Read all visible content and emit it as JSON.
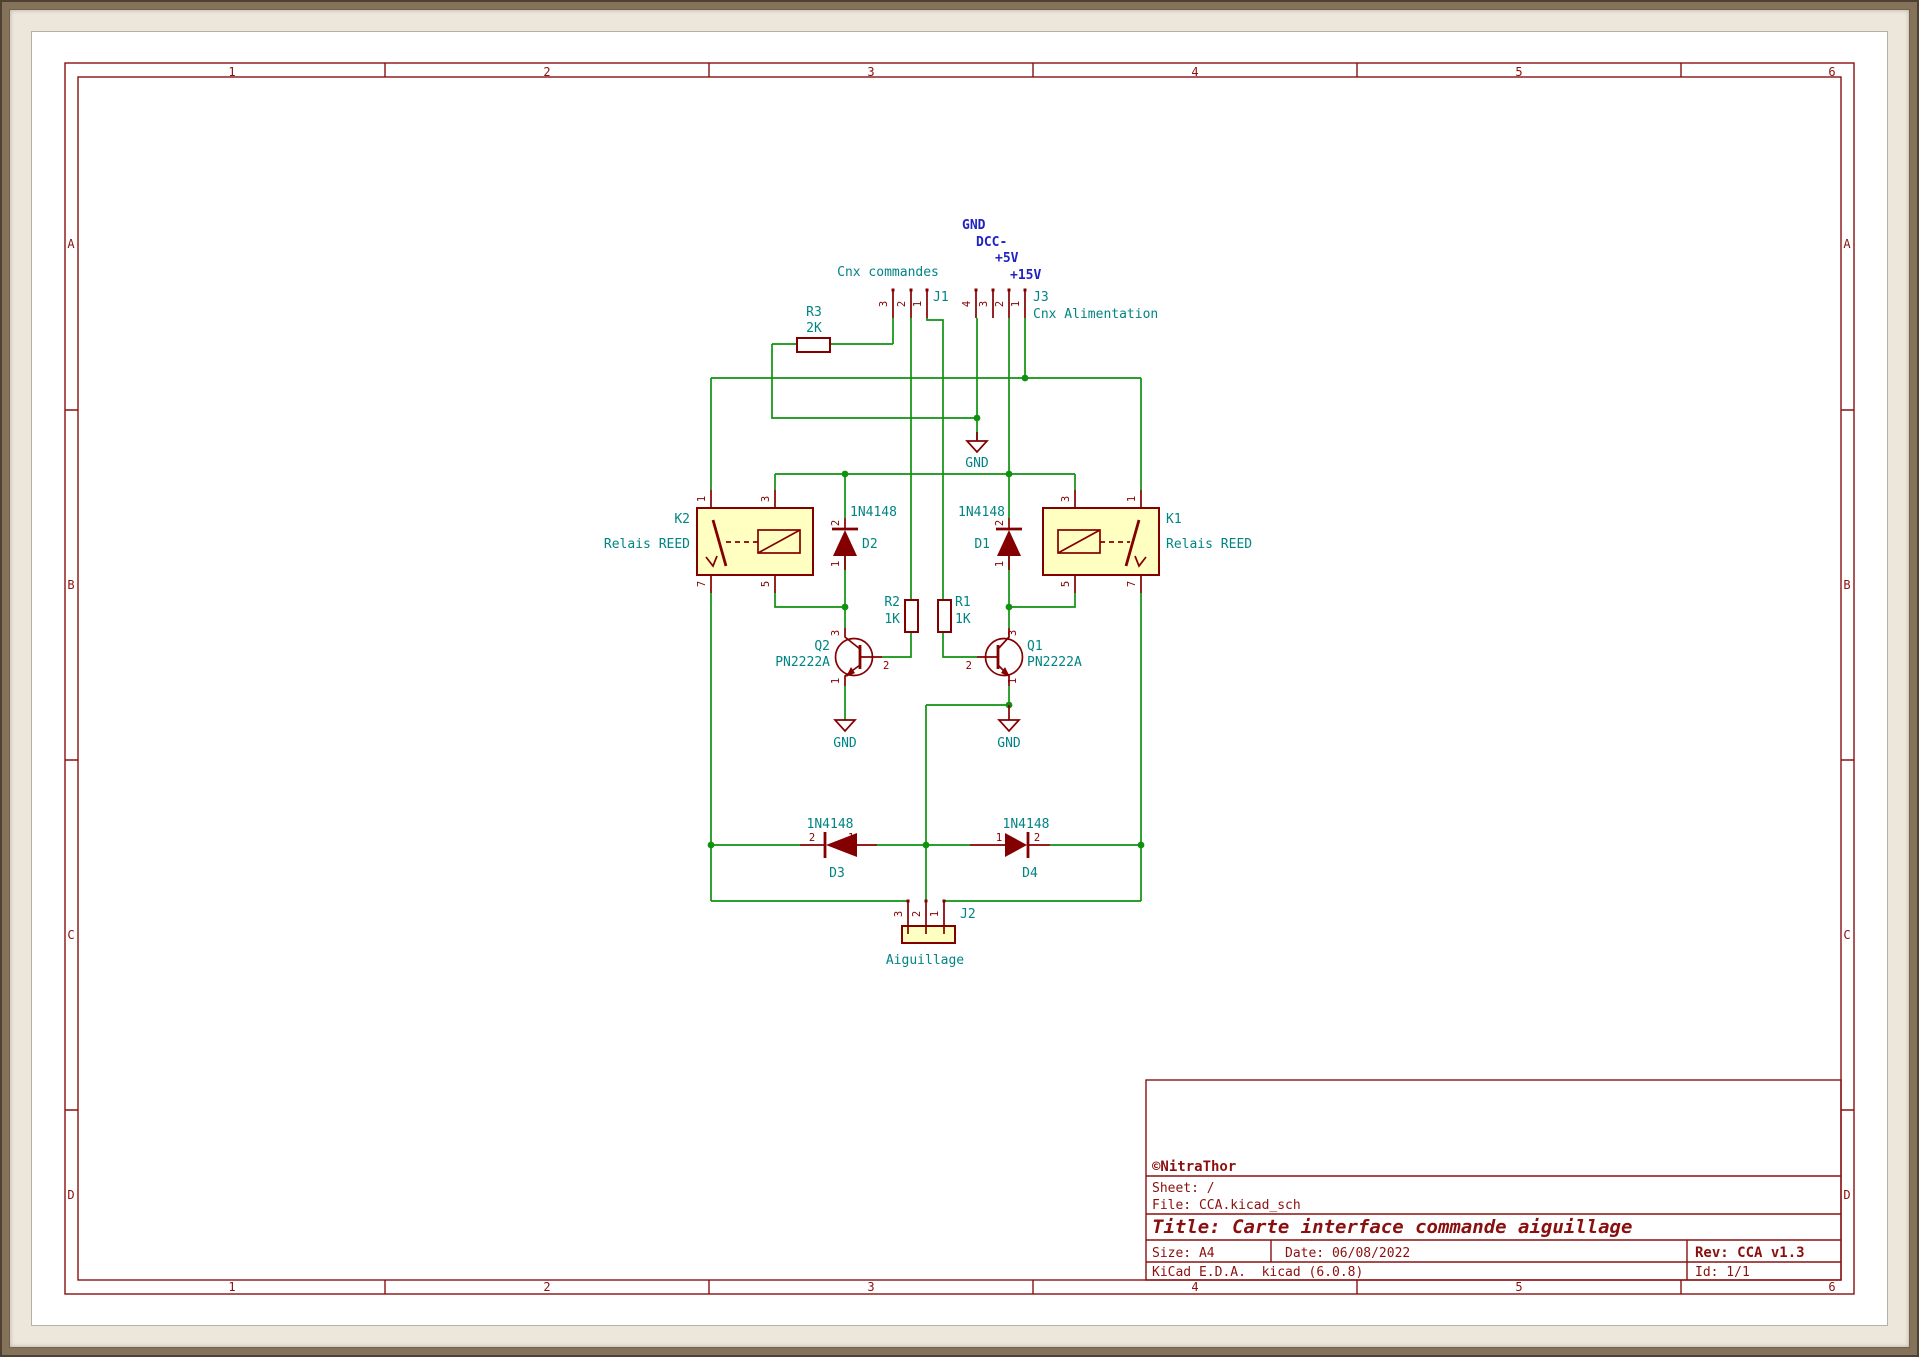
{
  "sheet": {
    "cols": [
      "1",
      "2",
      "3",
      "4",
      "5",
      "6"
    ],
    "rows": [
      "A",
      "B",
      "C",
      "D"
    ]
  },
  "title_block": {
    "company": "©NitraThor",
    "sheet": "Sheet: /",
    "file": "File: CCA.kicad_sch",
    "title": "Title: Carte interface commande aiguillage",
    "size": "Size: A4",
    "date": "Date: 06/08/2022",
    "rev": "Rev: CCA v1.3",
    "tool": "KiCad E.D.A.  kicad (6.0.8)",
    "id": "Id: 1/1"
  },
  "net_labels": {
    "gnd": "GND",
    "dcc_minus": "DCC-",
    "plus5v": "+5V",
    "plus15v": "+15V"
  },
  "power": {
    "gnd": "GND"
  },
  "components": {
    "J1": {
      "ref": "J1",
      "label": "Cnx commandes",
      "pins": [
        "3",
        "2",
        "1"
      ]
    },
    "J2": {
      "ref": "J2",
      "label": "Aiguillage",
      "pins": [
        "3",
        "2",
        "1"
      ]
    },
    "J3": {
      "ref": "J3",
      "label": "Cnx Alimentation",
      "pins": [
        "4",
        "3",
        "2",
        "1"
      ]
    },
    "K1": {
      "ref": "K1",
      "value": "Relais REED",
      "pins": {
        "tl": "3",
        "tr": "1",
        "bl": "5",
        "br": "7"
      }
    },
    "K2": {
      "ref": "K2",
      "value": "Relais REED",
      "pins": {
        "tl": "1",
        "tr": "3",
        "bl": "7",
        "br": "5"
      }
    },
    "R1": {
      "ref": "R1",
      "value": "1K"
    },
    "R2": {
      "ref": "R2",
      "value": "1K"
    },
    "R3": {
      "ref": "R3",
      "value": "2K"
    },
    "D1": {
      "ref": "D1",
      "value": "1N4148",
      "pins": {
        "top": "2",
        "bottom": "1"
      }
    },
    "D2": {
      "ref": "D2",
      "value": "1N4148",
      "pins": {
        "top": "2",
        "bottom": "1"
      }
    },
    "D3": {
      "ref": "D3",
      "value": "1N4148",
      "pins": {
        "left": "2",
        "right": "1"
      }
    },
    "D4": {
      "ref": "D4",
      "value": "1N4148",
      "pins": {
        "left": "1",
        "right": "2"
      }
    },
    "Q1": {
      "ref": "Q1",
      "value": "PN2222A",
      "pins": {
        "c": "3",
        "b": "2",
        "e": "1"
      }
    },
    "Q2": {
      "ref": "Q2",
      "value": "PN2222A",
      "pins": {
        "c": "3",
        "b": "2",
        "e": "1"
      }
    }
  },
  "colors": {
    "wire": "#0f930f",
    "device": "#840000",
    "label": "#008484",
    "net_label": "#2222c2",
    "symbol_fill": "#ffffc2",
    "sheet_line": "#8a1010"
  }
}
